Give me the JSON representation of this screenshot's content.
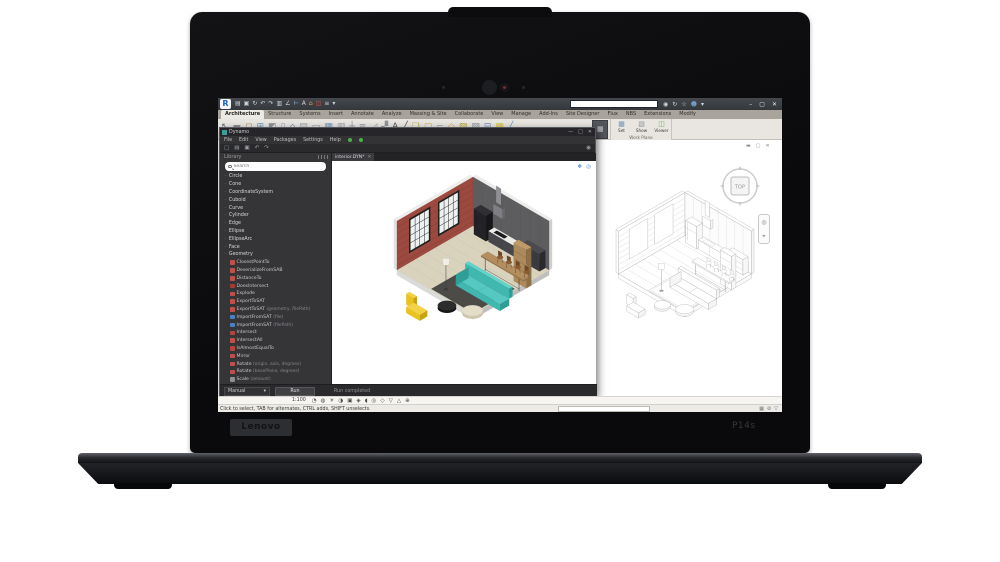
{
  "laptop": {
    "brand": "Lenovo",
    "model": "P14s"
  },
  "revit": {
    "logo_letter": "R",
    "qat_icons": [
      {
        "n": "open-icon",
        "g": "▤",
        "c": "#cdd3da"
      },
      {
        "n": "save-icon",
        "g": "▣",
        "c": "#cdd3da"
      },
      {
        "n": "sync-icon",
        "g": "↻",
        "c": "#cdd3da"
      },
      {
        "n": "undo-icon",
        "g": "↶",
        "c": "#cdd3da"
      },
      {
        "n": "redo-icon",
        "g": "↷",
        "c": "#cdd3da"
      },
      {
        "n": "print-icon",
        "g": "▥",
        "c": "#cdd3da"
      },
      {
        "n": "measure-icon",
        "g": "∠",
        "c": "#cdd3da"
      },
      {
        "n": "aligned-dimension-icon",
        "g": "⊢",
        "c": "#9fc2e8"
      },
      {
        "n": "text-icon",
        "g": "A",
        "c": "#cdd3da"
      },
      {
        "n": "3d-view-icon",
        "g": "⌂",
        "c": "#e8a33d"
      },
      {
        "n": "section-icon",
        "g": "◫",
        "c": "#cc5550"
      },
      {
        "n": "thin-lines-icon",
        "g": "≡",
        "c": "#cdd3da"
      },
      {
        "n": "ui-menu-icon",
        "g": "▾",
        "c": "#cdd3da"
      }
    ],
    "search": {
      "placeholder": "Type a keyword or phrase"
    },
    "titlebar_icons": [
      {
        "n": "search-help-icon",
        "g": "◉",
        "c": "#cfd5dc"
      },
      {
        "n": "refresh-icon",
        "g": "↻",
        "c": "#cfd5dc"
      },
      {
        "n": "favorites-star-icon",
        "g": "☆",
        "c": "#cfd5dc"
      },
      {
        "n": "signin-user-icon",
        "g": "☻",
        "c": "#7da7d9"
      },
      {
        "n": "dropdown-caret-icon",
        "g": "▾",
        "c": "#cfd5dc"
      }
    ],
    "window_controls": [
      {
        "n": "minimize-button",
        "g": "–"
      },
      {
        "n": "maximize-button",
        "g": "▢"
      },
      {
        "n": "close-button",
        "g": "✕"
      }
    ],
    "tabs": [
      {
        "label": "Architecture",
        "active": true
      },
      {
        "label": "Structure",
        "active": false
      },
      {
        "label": "Systems",
        "active": false
      },
      {
        "label": "Insert",
        "active": false
      },
      {
        "label": "Annotate",
        "active": false
      },
      {
        "label": "Analyze",
        "active": false
      },
      {
        "label": "Massing & Site",
        "active": false
      },
      {
        "label": "Collaborate",
        "active": false
      },
      {
        "label": "View",
        "active": false
      },
      {
        "label": "Manage",
        "active": false
      },
      {
        "label": "Add-Ins",
        "active": false
      },
      {
        "label": "Site Designer",
        "active": false
      },
      {
        "label": "Flux",
        "active": false
      },
      {
        "label": "NBS",
        "active": false
      },
      {
        "label": "Extensions",
        "active": false
      },
      {
        "label": "Modify",
        "active": false
      }
    ],
    "ribbon_icons": [
      {
        "n": "modify-tool-icon",
        "g": "↖",
        "c": "#5f6a75"
      },
      {
        "n": "wall-tool-icon",
        "g": "▬",
        "c": "#8a8f96"
      },
      {
        "n": "door-tool-icon",
        "g": "◻",
        "c": "#b08a5e"
      },
      {
        "n": "window-tool-icon",
        "g": "⊞",
        "c": "#6f93b8"
      },
      {
        "n": "component-tool-icon",
        "g": "◩",
        "c": "#8f949b"
      },
      {
        "n": "column-tool-icon",
        "g": "▯",
        "c": "#9aa0a7"
      },
      {
        "n": "roof-tool-icon",
        "g": "⌂",
        "c": "#7a97b5"
      },
      {
        "n": "ceiling-tool-icon",
        "g": "▤",
        "c": "#9aa0a7"
      },
      {
        "n": "floor-tool-icon",
        "g": "▭",
        "c": "#8f949b"
      },
      {
        "n": "curtain-system-icon",
        "g": "▦",
        "c": "#6f93b8"
      },
      {
        "n": "curtain-grid-icon",
        "g": "▥",
        "c": "#9aa0a7"
      },
      {
        "n": "mullion-icon",
        "g": "┼",
        "c": "#8f949b"
      },
      {
        "n": "railing-icon",
        "g": "≡",
        "c": "#8f949b"
      },
      {
        "n": "ramp-icon",
        "g": "◿",
        "c": "#9aa0a7"
      },
      {
        "n": "stair-icon",
        "g": "▞",
        "c": "#8f949b"
      },
      {
        "n": "model-text-icon",
        "g": "A",
        "c": "#55514b"
      },
      {
        "n": "model-line-icon",
        "g": "╱",
        "c": "#55514b"
      },
      {
        "n": "model-group-icon",
        "g": "❏",
        "c": "#b5a642"
      },
      {
        "n": "room-icon",
        "g": "▢",
        "c": "#d9a441"
      },
      {
        "n": "room-separator-icon",
        "g": "⌐",
        "c": "#9aa0a7"
      },
      {
        "n": "tag-room-icon",
        "g": "◇",
        "c": "#d9a441"
      },
      {
        "n": "area-icon",
        "g": "▨",
        "c": "#b5a642"
      },
      {
        "n": "shaft-icon",
        "g": "▧",
        "c": "#8f949b"
      },
      {
        "n": "level-icon",
        "g": "⊟",
        "c": "#6f93b8"
      },
      {
        "n": "grid-icon",
        "g": "▩",
        "c": "#d9c341"
      },
      {
        "n": "ref-plane-icon",
        "g": "╱",
        "c": "#6f93b8"
      }
    ],
    "flyout_icon": {
      "n": "grid-flyout-icon",
      "g": "▦"
    },
    "workplane_panel": {
      "caption": "Work Plane",
      "datum_caption": "Datum",
      "buttons": [
        {
          "label": "Set",
          "n": "set-workplane-button",
          "g": "▦",
          "c": "#6f93b8"
        },
        {
          "label": "Show",
          "n": "show-workplane-button",
          "g": "▧",
          "c": "#8f949b"
        },
        {
          "label": "Viewer",
          "n": "workplane-viewer-button",
          "g": "◫",
          "c": "#6fae6f"
        }
      ]
    },
    "view_window_controls": [
      {
        "n": "view-minimize-icon",
        "g": "▬"
      },
      {
        "n": "view-restore-icon",
        "g": "▢"
      },
      {
        "n": "view-close-icon",
        "g": "✕"
      }
    ],
    "viewcube": {
      "top_label": "TOP"
    },
    "navbar_icons": [
      {
        "n": "steering-wheel-icon",
        "g": "◎"
      },
      {
        "n": "zoom-icon",
        "g": "⌖"
      }
    ],
    "view_controls": {
      "scale": "1:100",
      "icons": [
        {
          "n": "detail-level-icon",
          "g": "◔"
        },
        {
          "n": "visual-style-icon",
          "g": "◍"
        },
        {
          "n": "sun-path-icon",
          "g": "☀"
        },
        {
          "n": "shadows-icon",
          "g": "◑"
        },
        {
          "n": "crop-view-icon",
          "g": "▣"
        },
        {
          "n": "crop-region-visible-icon",
          "g": "◈"
        },
        {
          "n": "temporary-hide-icon",
          "g": "◖"
        },
        {
          "n": "reveal-hidden-icon",
          "g": "◎"
        },
        {
          "n": "worksharing-display-icon",
          "g": "◇"
        },
        {
          "n": "temporary-view-properties-icon",
          "g": "▽"
        },
        {
          "n": "analytical-model-icon",
          "g": "△"
        },
        {
          "n": "constraints-icon",
          "g": "⊕"
        }
      ]
    },
    "statusbar": {
      "hint": "Click to select, TAB for alternates, CTRL adds, SHIFT unselects.",
      "right_icons": [
        {
          "n": "editable-only-icon",
          "g": "▦"
        },
        {
          "n": "exclude-options-icon",
          "g": "⊘"
        },
        {
          "n": "filter-icon",
          "g": "▽"
        }
      ]
    }
  },
  "dynamo": {
    "title": "Dynamo",
    "window_controls": [
      {
        "n": "dynamo-minimize-button",
        "g": "—"
      },
      {
        "n": "dynamo-maximize-button",
        "g": "□"
      },
      {
        "n": "dynamo-close-button",
        "g": "✕"
      }
    ],
    "menus": [
      "File",
      "Edit",
      "View",
      "Packages",
      "Settings",
      "Help"
    ],
    "toolbar_icons": [
      {
        "n": "new-file-icon",
        "g": "▢"
      },
      {
        "n": "open-file-icon",
        "g": "▤"
      },
      {
        "n": "save-file-icon",
        "g": "▣"
      },
      {
        "n": "undo-icon",
        "g": "↶"
      },
      {
        "n": "redo-icon",
        "g": "↷"
      }
    ],
    "export_image_icon": {
      "n": "export-workspace-image-icon",
      "g": "◉"
    },
    "library": {
      "title": "Library",
      "search_placeholder": "Search",
      "items": [
        {
          "type": "cat",
          "label": "Circle"
        },
        {
          "type": "cat",
          "label": "Cone"
        },
        {
          "type": "cat",
          "label": "CoordinateSystem"
        },
        {
          "type": "cat",
          "label": "Cuboid"
        },
        {
          "type": "cat",
          "label": "Curve"
        },
        {
          "type": "cat",
          "label": "Cylinder"
        },
        {
          "type": "cat",
          "label": "Edge"
        },
        {
          "type": "cat",
          "label": "Ellipse"
        },
        {
          "type": "cat",
          "label": "EllipseArc"
        },
        {
          "type": "cat",
          "label": "Face"
        },
        {
          "type": "cat",
          "label": "Geometry"
        },
        {
          "type": "node",
          "label": "ClosestPointTo",
          "args": "",
          "ic": "#c14f4a"
        },
        {
          "type": "node",
          "label": "DeserializeFromSAB",
          "args": "",
          "ic": "#c14f4a"
        },
        {
          "type": "node",
          "label": "DistanceTo",
          "args": "",
          "ic": "#c14f4a"
        },
        {
          "type": "node",
          "label": "DoesIntersect",
          "args": "",
          "ic": "#a83a36"
        },
        {
          "type": "node",
          "label": "Explode",
          "args": "",
          "ic": "#c14f4a"
        },
        {
          "type": "node",
          "label": "ExportToSAT",
          "args": "",
          "ic": "#c14f4a"
        },
        {
          "type": "node",
          "label": "ExportToSAT",
          "args": "(geometry, filePath)",
          "ic": "#c14f4a"
        },
        {
          "type": "node",
          "label": "ImportFromSAT",
          "args": "(file)",
          "ic": "#4a7fc1"
        },
        {
          "type": "node",
          "label": "ImportFromSAT",
          "args": "(filePath)",
          "ic": "#4a7fc1"
        },
        {
          "type": "node",
          "label": "Intersect",
          "args": "",
          "ic": "#b5443f"
        },
        {
          "type": "node",
          "label": "IntersectAll",
          "args": "",
          "ic": "#c14f4a"
        },
        {
          "type": "node",
          "label": "IsAlmostEqualTo",
          "args": "",
          "ic": "#b5443f"
        },
        {
          "type": "node",
          "label": "Mirror",
          "args": "",
          "ic": "#c14f4a"
        },
        {
          "type": "node",
          "label": "Rotate",
          "args": "(origin, axis, degrees)",
          "ic": "#c14f4a"
        },
        {
          "type": "node",
          "label": "Rotate",
          "args": "(basePlane, degrees)",
          "ic": "#c14f4a"
        },
        {
          "type": "node",
          "label": "Scale",
          "args": "(amount)",
          "ic": "#8f8f94"
        },
        {
          "type": "node",
          "label": "Scale",
          "args": "(basePlane, xamount, yamount, zamount)",
          "ic": "#8f8f94"
        }
      ]
    },
    "canvas": {
      "tab_label": "interior.DYN*",
      "preview_icons": [
        {
          "n": "geometry-preview-icon",
          "g": "❖"
        },
        {
          "n": "camera-view-icon",
          "g": "◎"
        }
      ]
    },
    "run": {
      "mode": "Manual",
      "button": "Run",
      "status": "Run completed"
    }
  }
}
